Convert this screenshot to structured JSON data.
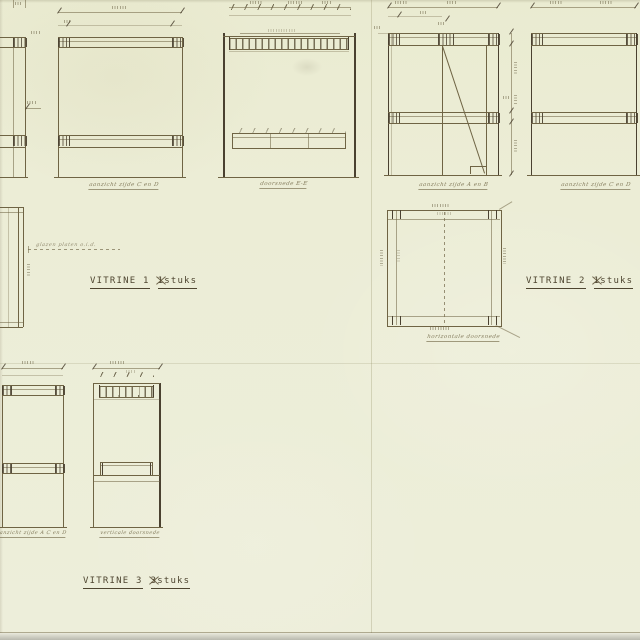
{
  "sheet": {
    "labels": [
      {
        "title": "VITRINE 1",
        "qty": "1",
        "unit": "stuks"
      },
      {
        "title": "VITRINE 2",
        "qty": "1",
        "unit": "stuks"
      },
      {
        "title": "VITRINE 3",
        "qty": "3",
        "unit": "stuks"
      }
    ],
    "captions": {
      "v1_front": "aanzicht zijde C en D",
      "v1_section": "doorsnede E-E",
      "v2_front": "aanzicht zijde A en B",
      "v2_side": "aanzicht zijde C en D",
      "v2_plan": "horizontale doorsnede",
      "v3_front": "aanzicht zijde A C en D",
      "v3_section": "verticale doorsnede",
      "v1_note": "glazen platen o.i.d."
    },
    "colors": {
      "paper": "#ecedd6",
      "ink": "#6f6444",
      "ink_dark": "#4a4130",
      "label": "#4e4530"
    }
  }
}
